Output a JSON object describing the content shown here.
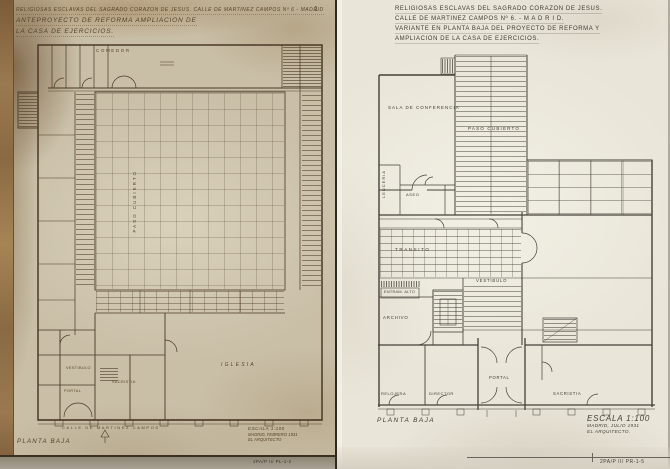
{
  "left": {
    "page_mark": "1",
    "title_lines": [
      "RELIGIOSAS ESCLAVAS DEL SAGRADO CORAZON DE JESUS. CALLE DE MARTINEZ CAMPOS Nº 6 - MADRID",
      "ANTEPROYECTO DE REFORMA AMPLIACION DE",
      "LA CASA DE EJERCICIOS."
    ],
    "labels": {
      "comedor": "COMEDOR",
      "paso_cubierto": "PASO CUBIERTO",
      "iglesia": "IGLESIA",
      "vestibulo": "VESTIBULO",
      "portal": "PORTAL",
      "sacristia": "SACRISTIA",
      "street": "CALLE DE MARTINEZ CAMPOS",
      "floor": "PLANTA BAJA"
    },
    "scale_lines": [
      "ESCALA 1:100",
      "MADRID, FEBRERO 1931",
      "EL ARQUITECTO"
    ],
    "code": "2PA/P II/ PL-1-2"
  },
  "right": {
    "title_lines": [
      "RELIGIOSAS ESCLAVAS DEL SAGRADO CORAZON DE JESUS.",
      "CALLE DE MARTINEZ CAMPOS Nº 6. - M A D R I D.",
      "VARIANTE EN PLANTA BAJA DEL PROYECTO DE REFORMA Y",
      "AMPLIACION DE LA CASA DE EJERCICIOS."
    ],
    "labels": {
      "sala_conferencia": "SALA DE CONFERENCIA",
      "paso_cubierto": "PASO CUBIERTO",
      "lenceria": "LENCERIA",
      "aseo": "ASEO",
      "transito": "TRANSITO",
      "vestibulo": "VESTIBULO",
      "entram_alto": "ENTRAM. ALTO",
      "archivo": "ARCHIVO",
      "relojera": "RELOJERA",
      "director": "DIRECTOR",
      "portal": "PORTAL",
      "sacristia": "SACRISTIA",
      "floor": "PLANTA BAJA"
    },
    "scale_lines": [
      "ESCALA 1:100",
      "MADRID, JULIO 1931",
      "EL ARQUITECTO."
    ],
    "code": "2PA/P II/ PR-1-5"
  }
}
